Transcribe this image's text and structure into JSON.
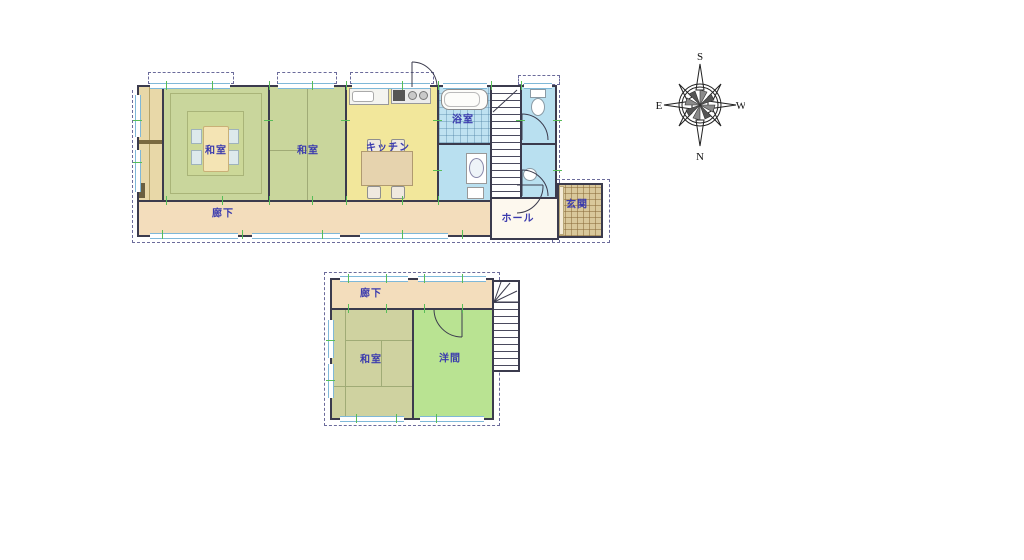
{
  "floor1": {
    "washitsu1": "和室",
    "washitsu2": "和室",
    "kitchen": "キッチン",
    "bath": "浴室",
    "corridor": "廊下",
    "hall": "ホール",
    "entrance": "玄関"
  },
  "floor2": {
    "corridor": "廊下",
    "washitsu": "和室",
    "western": "洋間"
  },
  "compass": {
    "top": "S",
    "bottom": "N",
    "left": "E",
    "right": "W"
  },
  "colors": {
    "tatami_1f": "#c9d69c",
    "tatami_2f": "#cfd2a0",
    "western_room": "#b9e392",
    "kitchen": "#f2e79b",
    "corridor": "#f3ddbc",
    "wet_area": "#bfe2f1",
    "hall": "#fdf8ee",
    "entrance": "#d9c89b",
    "wall": "#3b3b4d",
    "label_text": "#3a3aae",
    "tick_mark": "#58bd58"
  }
}
